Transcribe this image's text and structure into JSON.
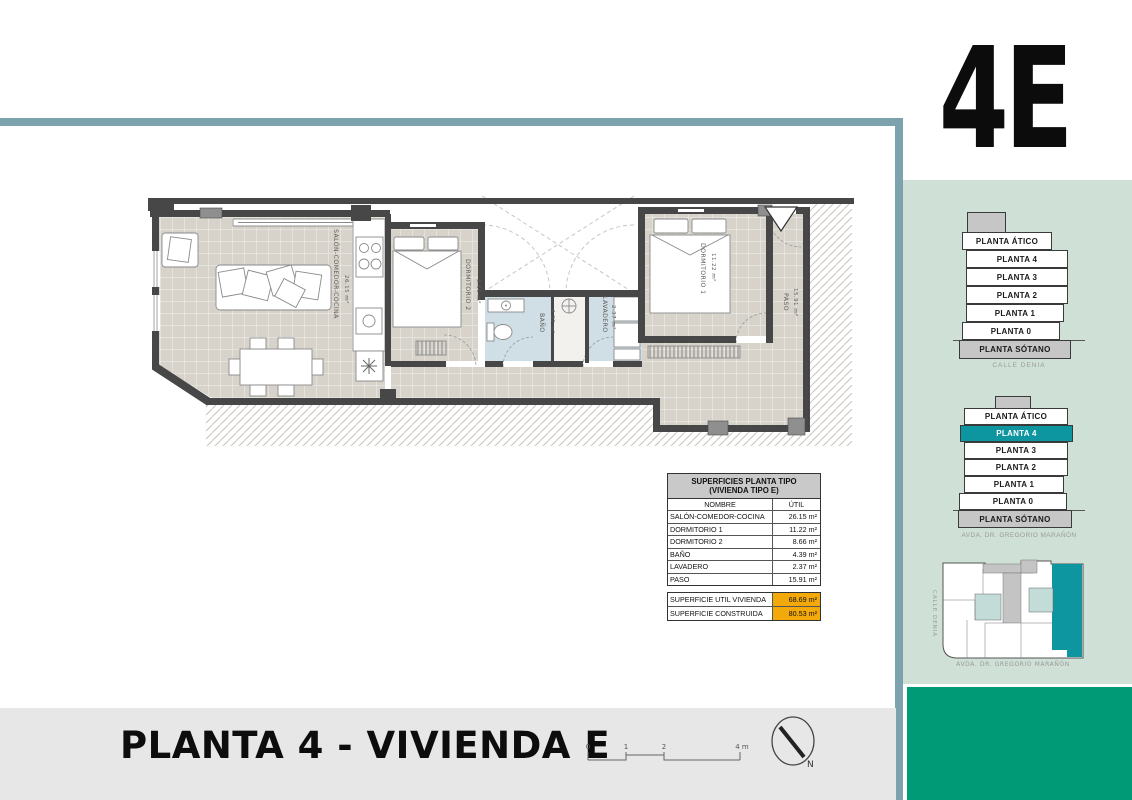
{
  "unit_label": "4E",
  "footer": {
    "title": "PLANTA 4 - VIVIENDA E",
    "scale_ticks": [
      "0",
      "1",
      "2",
      "4 m"
    ],
    "north_label": "N"
  },
  "plan": {
    "rooms": [
      {
        "name": "SALÓN-COMEDOR-COCINA",
        "area": "26.15 m²"
      },
      {
        "name": "DORMITORIO 2",
        "area": "8.66 m²"
      },
      {
        "name": "BAÑO",
        "area": "4.39 m²"
      },
      {
        "name": "LAVADERO",
        "area": "2.37 m²"
      },
      {
        "name": "DORMITORIO 1",
        "area": "11.22 m²"
      },
      {
        "name": "PASO",
        "area": "15.91 m²"
      }
    ]
  },
  "table": {
    "title_line1": "SUPERFICIES PLANTA TIPO",
    "title_line2": "(VIVIENDA TIPO E)",
    "col_name": "NOMBRE",
    "col_util": "ÚTIL",
    "rows": [
      {
        "name": "SALÓN-COMEDOR-COCINA",
        "util": "26.15 m²"
      },
      {
        "name": "DORMITORIO 1",
        "util": "11.22 m²"
      },
      {
        "name": "DORMITORIO 2",
        "util": "8.66 m²"
      },
      {
        "name": "BAÑO",
        "util": "4.39 m²"
      },
      {
        "name": "LAVADERO",
        "util": "2.37 m²"
      },
      {
        "name": "PASO",
        "util": "15.91 m²"
      }
    ],
    "totals": [
      {
        "name": "SUPERFICIE UTIL VIVIENDA",
        "value": "68.69 m²"
      },
      {
        "name": "SUPERFICIE CONSTRUIDA",
        "value": "80.53 m²"
      }
    ]
  },
  "sidebar": {
    "stack1": {
      "floors": [
        "PLANTA ÁTICO",
        "PLANTA 4",
        "PLANTA 3",
        "PLANTA 2",
        "PLANTA 1",
        "PLANTA 0",
        "PLANTA SÓTANO"
      ],
      "caption": "CALLE DENIA"
    },
    "stack2": {
      "floors": [
        "PLANTA ÁTICO",
        "PLANTA 4",
        "PLANTA 3",
        "PLANTA 2",
        "PLANTA 1",
        "PLANTA 0",
        "PLANTA SÓTANO"
      ],
      "highlighted": "PLANTA 4",
      "caption": "AVDA. DR. GREGORIO MARAÑÓN"
    },
    "siteplan": {
      "street_left": "CALLE DENIA",
      "street_bottom": "AVDA. DR. GREGORIO MARAÑÓN"
    }
  },
  "colors": {
    "frame_teal": "#7ca3ad",
    "sidebar_green": "#cfe0d6",
    "brand_green": "#009b76",
    "highlight_teal": "#0d96a0",
    "highlight_orange": "#f3a90a"
  }
}
